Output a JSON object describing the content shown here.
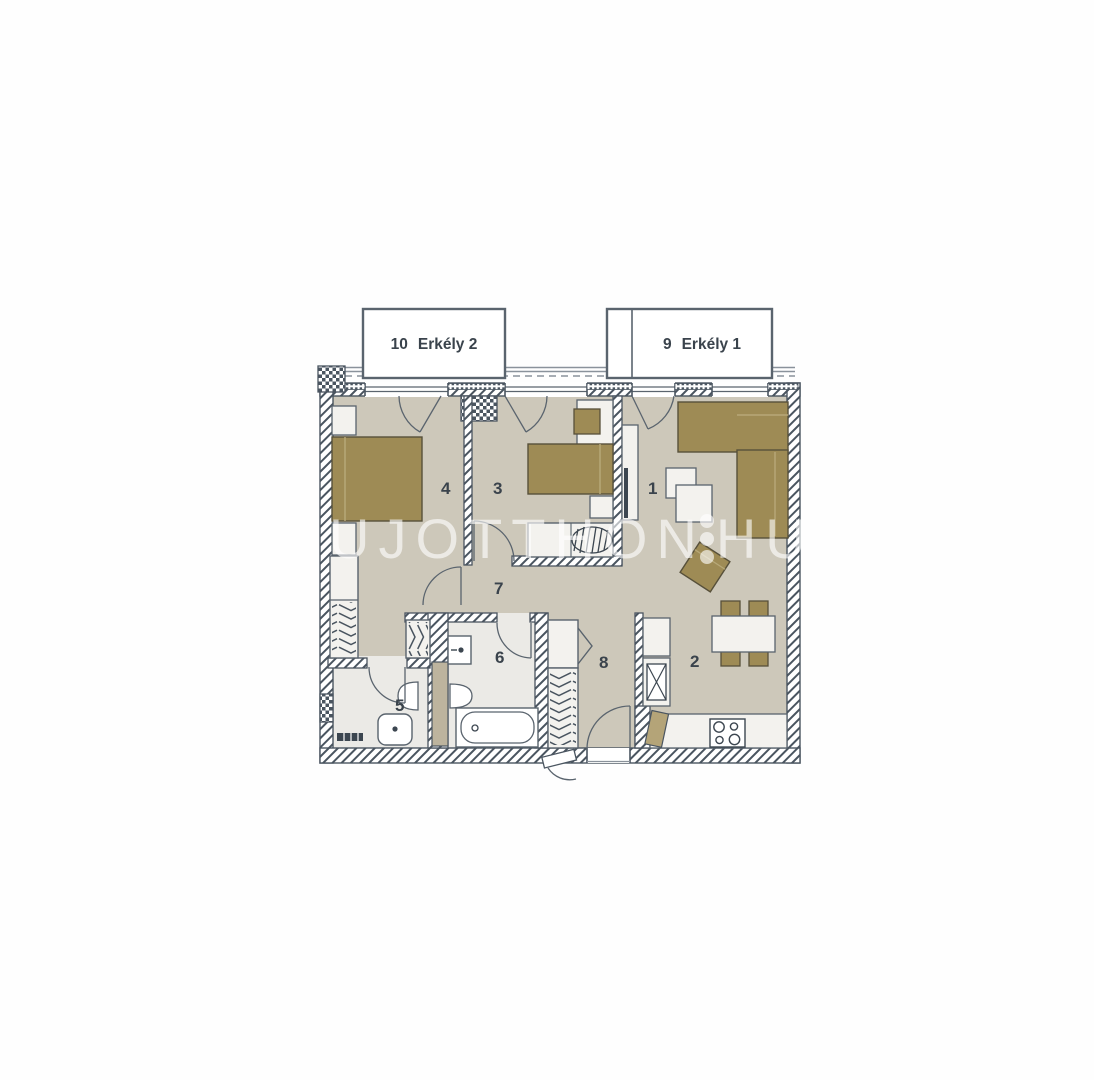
{
  "palette": {
    "wall_line": "#4a5560",
    "floor_main": "#cdc8ba",
    "floor_wet": "#ebeae6",
    "furniture_brown": "#9e8b55",
    "furniture_white": "#f3f2ee",
    "label_color": "#3a434c",
    "watermark_color": "#ffffff"
  },
  "balconies": [
    {
      "number": "10",
      "name": "Erkély 2"
    },
    {
      "number": "9",
      "name": "Erkély 1"
    }
  ],
  "rooms": [
    {
      "number": "1"
    },
    {
      "number": "2"
    },
    {
      "number": "3"
    },
    {
      "number": "4"
    },
    {
      "number": "5"
    },
    {
      "number": "6"
    },
    {
      "number": "7"
    },
    {
      "number": "8"
    }
  ],
  "watermark": {
    "text_left": "UJOTTHON",
    "text_right": "HU"
  }
}
